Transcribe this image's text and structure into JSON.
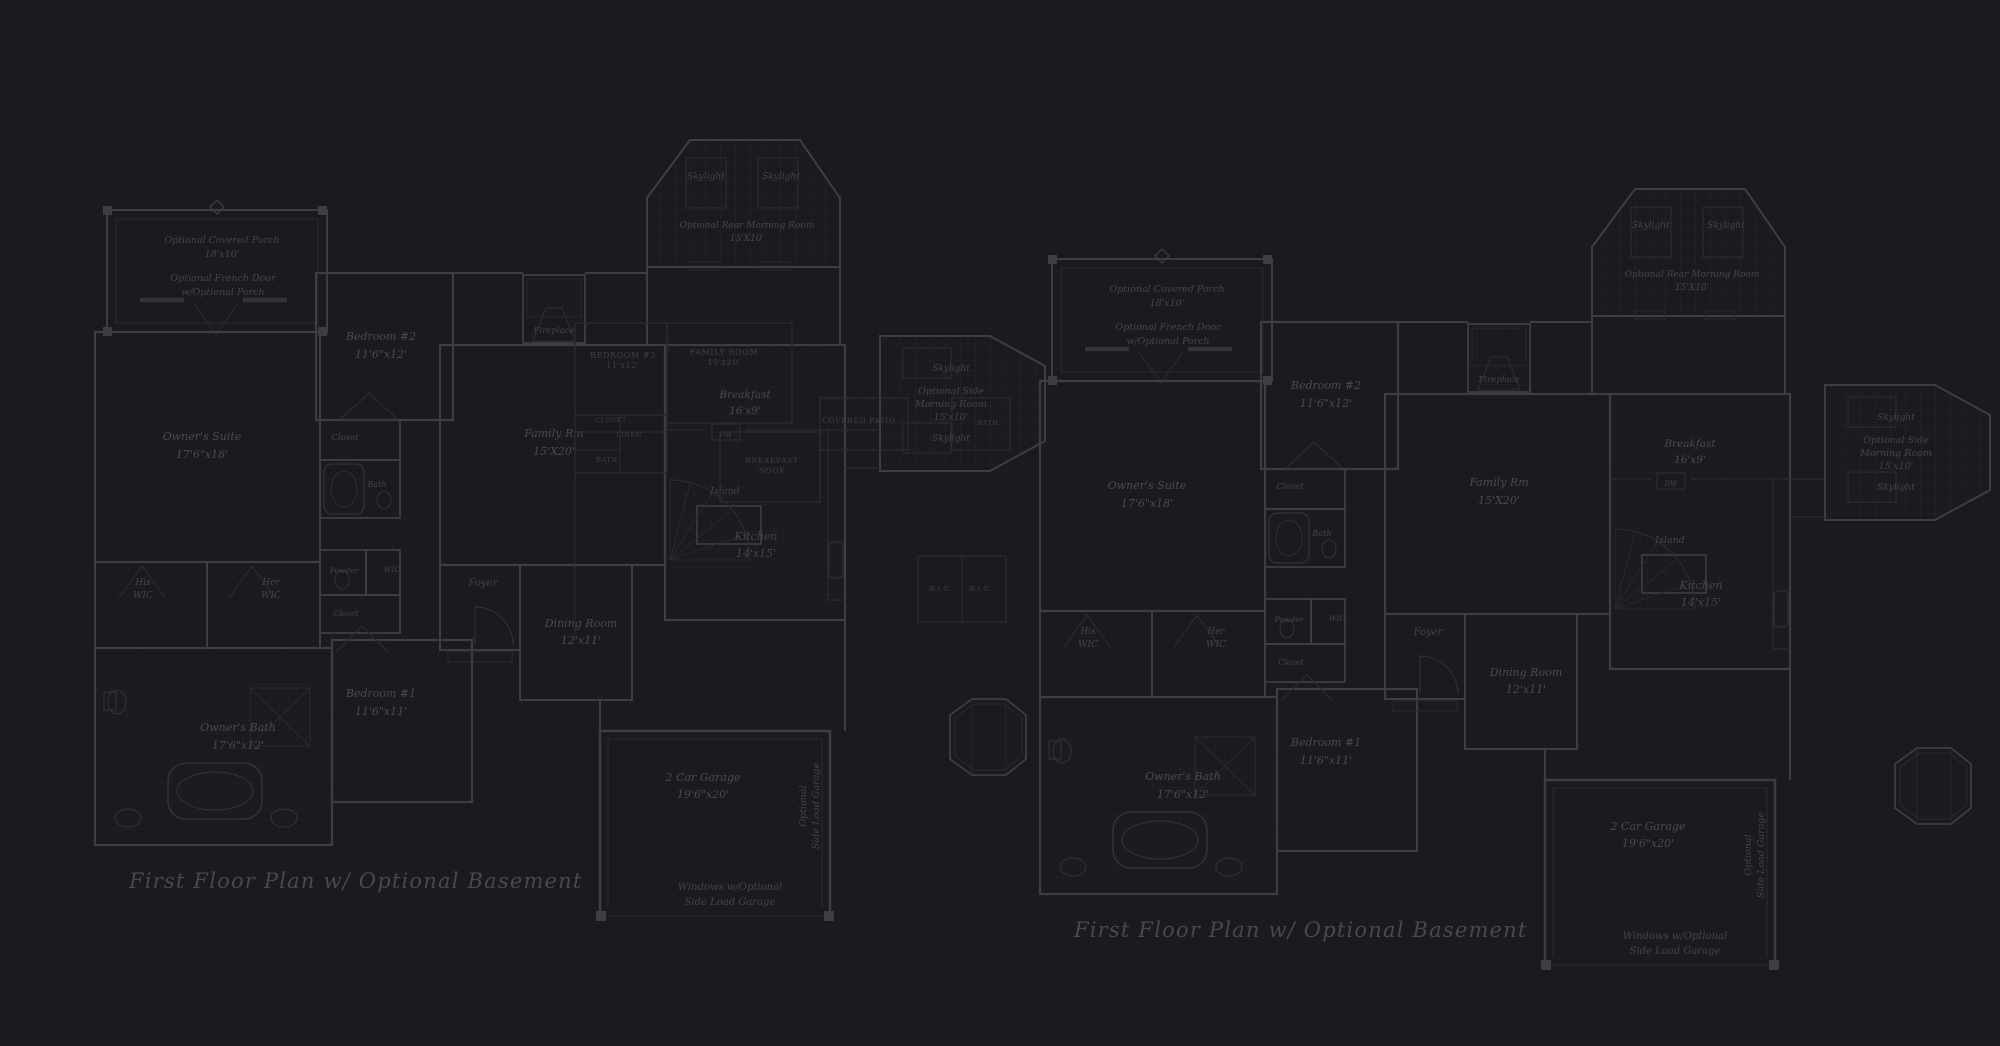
{
  "sheet": {
    "background": "#1b1a1e",
    "wall_color": "#3e3d43",
    "faint_color": "#2c2b31",
    "fixture_color": "#343339",
    "tile_color": "#232229",
    "grid_color": "#27262c",
    "label_color": "#4b4952",
    "small_label_color": "#45444c",
    "caps_label_color": "#403f47",
    "title_color": "#4a4753"
  },
  "plans": [
    {
      "name": "first-floor-plan-left",
      "title": "First Floor Plan  w/ Optional Basement",
      "offset": {
        "x": 0,
        "y": 0
      }
    },
    {
      "name": "first-floor-plan-right",
      "title": "First Floor Plan  w/ Optional Basement",
      "offset": {
        "x": 945,
        "y": 49
      }
    }
  ],
  "title_pos": {
    "x": 129,
    "y": 888,
    "size": 21
  },
  "room_labels": [
    {
      "id": "covered-porch",
      "lines": [
        "Optional Covered Porch",
        "18'x10'"
      ],
      "x": 222,
      "y": 243,
      "fs": 9.5,
      "lh": 14
    },
    {
      "id": "french-door-note",
      "lines": [
        "Optional French Door",
        "w/Optional Porch"
      ],
      "x": 223,
      "y": 281,
      "fs": 9.5,
      "lh": 14
    },
    {
      "id": "bedroom-2",
      "lines": [
        "Bedroom #2",
        "11'6\"x12'"
      ],
      "x": 381,
      "y": 340,
      "fs": 11,
      "lh": 18
    },
    {
      "id": "owners-suite",
      "lines": [
        "Owner's Suite",
        "17'6\"x18'"
      ],
      "x": 202,
      "y": 440,
      "fs": 11,
      "lh": 18
    },
    {
      "id": "closet-upper",
      "lines": [
        "Closet"
      ],
      "x": 345,
      "y": 440,
      "fs": 8.5,
      "lh": 11
    },
    {
      "id": "bath-upper",
      "lines": [
        "Bath"
      ],
      "x": 377,
      "y": 487,
      "fs": 8,
      "lh": 11
    },
    {
      "id": "his-wic",
      "lines": [
        "His",
        "WIC"
      ],
      "x": 143,
      "y": 585,
      "fs": 9,
      "lh": 13
    },
    {
      "id": "her-wic",
      "lines": [
        "Her",
        "WIC"
      ],
      "x": 271,
      "y": 585,
      "fs": 9,
      "lh": 13
    },
    {
      "id": "powder",
      "lines": [
        "Powder"
      ],
      "x": 344,
      "y": 573,
      "fs": 7.5,
      "lh": 10
    },
    {
      "id": "wic-small",
      "lines": [
        "WIC"
      ],
      "x": 392,
      "y": 572,
      "fs": 7.5,
      "lh": 10
    },
    {
      "id": "closet-lower",
      "lines": [
        "Closet"
      ],
      "x": 346,
      "y": 616,
      "fs": 8,
      "lh": 11
    },
    {
      "id": "bedroom-1",
      "lines": [
        "Bedroom #1",
        "11'6\"x11'"
      ],
      "x": 381,
      "y": 697,
      "fs": 11,
      "lh": 18
    },
    {
      "id": "owners-bath",
      "lines": [
        "Owner's Bath",
        "17'6\"x12'"
      ],
      "x": 238,
      "y": 731,
      "fs": 11,
      "lh": 18
    },
    {
      "id": "foyer",
      "lines": [
        "Foyer"
      ],
      "x": 483,
      "y": 586,
      "fs": 10,
      "lh": 12
    },
    {
      "id": "dining-room",
      "lines": [
        "Dining Room",
        "12'x11'"
      ],
      "x": 581,
      "y": 627,
      "fs": 11,
      "lh": 17
    },
    {
      "id": "family-rm",
      "lines": [
        "Family Rm",
        "15'X20'"
      ],
      "x": 554,
      "y": 437,
      "fs": 11,
      "lh": 18
    },
    {
      "id": "fireplace",
      "lines": [
        "Fireplace"
      ],
      "x": 554,
      "y": 333,
      "fs": 8.5,
      "lh": 11
    },
    {
      "id": "skylight-rear-1",
      "lines": [
        "Skylight"
      ],
      "x": 706,
      "y": 179,
      "fs": 9,
      "lh": 11
    },
    {
      "id": "skylight-rear-2",
      "lines": [
        "Skylight"
      ],
      "x": 781,
      "y": 179,
      "fs": 9,
      "lh": 11
    },
    {
      "id": "rear-morning-room",
      "lines": [
        "Optional Rear Morning Room",
        "15'X10'"
      ],
      "x": 747,
      "y": 228,
      "fs": 9,
      "lh": 13
    },
    {
      "id": "breakfast",
      "lines": [
        "Breakfast",
        "16'x9'"
      ],
      "x": 745,
      "y": 398,
      "fs": 10.5,
      "lh": 16
    },
    {
      "id": "dw",
      "lines": [
        "DW"
      ],
      "x": 726,
      "y": 437,
      "fs": 7,
      "lh": 9
    },
    {
      "id": "island",
      "lines": [
        "Island"
      ],
      "x": 725,
      "y": 494,
      "fs": 9.5,
      "lh": 11
    },
    {
      "id": "kitchen",
      "lines": [
        "Kitchen",
        "14'x15'"
      ],
      "x": 756,
      "y": 540,
      "fs": 11,
      "lh": 17
    },
    {
      "id": "skylight-side-top",
      "lines": [
        "Skylight"
      ],
      "x": 951,
      "y": 371,
      "fs": 9,
      "lh": 11
    },
    {
      "id": "side-morning-room",
      "lines": [
        "Optional Side",
        "Morning Room",
        "15'x10'"
      ],
      "x": 951,
      "y": 394,
      "fs": 9.5,
      "lh": 13
    },
    {
      "id": "skylight-side-bot",
      "lines": [
        "Skylight"
      ],
      "x": 951,
      "y": 441,
      "fs": 9,
      "lh": 11
    },
    {
      "id": "garage",
      "lines": [
        "2 Car Garage",
        "19'6\"x20'"
      ],
      "x": 703,
      "y": 781,
      "fs": 11,
      "lh": 17
    },
    {
      "id": "side-load-garage",
      "lines": [
        "Optional",
        "Side Load Garage"
      ],
      "x": 806,
      "y": 806,
      "fs": 9.5,
      "lh": 13,
      "rot": -90
    },
    {
      "id": "windows-note",
      "lines": [
        "Windows w/Optional",
        "Side Load Garage"
      ],
      "x": 730,
      "y": 890,
      "fs": 10,
      "lh": 15
    }
  ],
  "overlay_labels": [
    {
      "id": "ov-bedroom-3",
      "lines": [
        "BEDROOM #3",
        "11'x12'"
      ],
      "x": 623,
      "y": 358,
      "fs": 8,
      "lh": 10
    },
    {
      "id": "ov-family-room",
      "lines": [
        "FAMILY ROOM",
        "15'x20'"
      ],
      "x": 724,
      "y": 355,
      "fs": 8,
      "lh": 10
    },
    {
      "id": "ov-closet",
      "lines": [
        "CLOSET"
      ],
      "x": 611,
      "y": 422,
      "fs": 6.5,
      "lh": 8
    },
    {
      "id": "ov-linen",
      "lines": [
        "LINEN"
      ],
      "x": 629,
      "y": 437,
      "fs": 6.5,
      "lh": 8
    },
    {
      "id": "ov-bath-west",
      "lines": [
        "BATH"
      ],
      "x": 607,
      "y": 462,
      "fs": 6.5,
      "lh": 8
    },
    {
      "id": "ov-breakfast-nook",
      "lines": [
        "BREAKFAST",
        "NOOK"
      ],
      "x": 772,
      "y": 463,
      "fs": 7.5,
      "lh": 10
    },
    {
      "id": "ov-covered-patio",
      "lines": [
        "COVERED PATIO"
      ],
      "x": 859,
      "y": 423,
      "fs": 7.5,
      "lh": 9
    },
    {
      "id": "ov-bath-east",
      "lines": [
        "BATH"
      ],
      "x": 988,
      "y": 425,
      "fs": 6.5,
      "lh": 8
    },
    {
      "id": "ov-wic-1",
      "lines": [
        "W.I.C."
      ],
      "x": 940,
      "y": 591,
      "fs": 6.5,
      "lh": 8
    },
    {
      "id": "ov-wic-2",
      "lines": [
        "W.I.C."
      ],
      "x": 980,
      "y": 591,
      "fs": 6.5,
      "lh": 8
    }
  ]
}
